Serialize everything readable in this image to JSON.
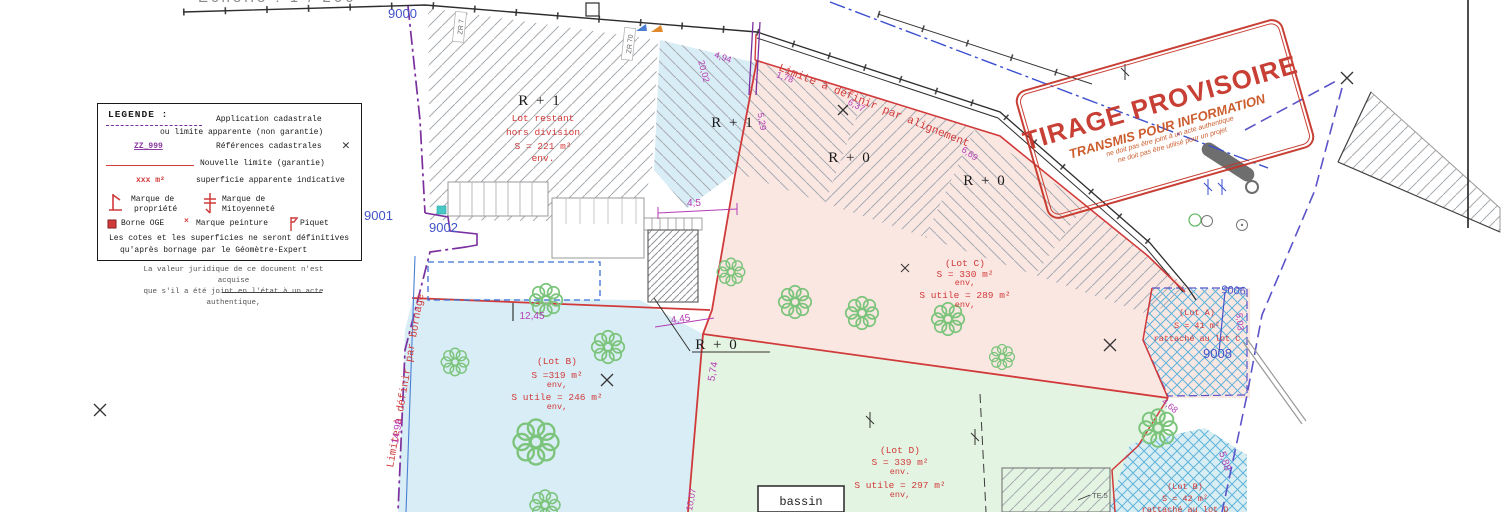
{
  "meta": {
    "scale_note": "Echelle : 1 / 200"
  },
  "stamp": {
    "line1": "TIRAGE PROVISOIRE",
    "line2": "TRANSMIS POUR INFORMATION",
    "line3": "ne doit pas être joint à un acte authentique",
    "line4": "ne doit pas être utilisé pour un projet"
  },
  "legend": {
    "title": "LEGENDE :",
    "app1": "Application cadastrale",
    "app2": "ou limite apparente (non garantie)",
    "ref_code": "ZZ_999",
    "ref_label": "Références cadastrales",
    "new_limit": "Nouvelle limite (garantie)",
    "area_code": "xxx m²",
    "area_label": "superficie apparente indicative",
    "mark1a": "Marque de",
    "mark1b": "propriété",
    "mark2a": "Marque de",
    "mark2b": "Mitoyenneté",
    "borne": "Borne OGE",
    "peinture": "Marque peinture",
    "piquet": "Piquet",
    "note1": "Les cotes et les superficies ne seront définitives",
    "note2": "qu'après bornage par le Géomètre-Expert"
  },
  "footer_note": {
    "line1": "La valeur juridique de ce document n'est acquise",
    "line2": "que s'il a été joint en l'état à un acte authentique,"
  },
  "points": {
    "p9000": "9000",
    "p9001": "9001",
    "p9002": "9002",
    "p9005": "9005",
    "p9008": "9008"
  },
  "floors": {
    "r1_main": "R + 1",
    "r1_b": "R + 1",
    "r0_a": "R + 0",
    "r0_b": "R + 0",
    "r0_c": "R + 0"
  },
  "lot_restant": {
    "l1": "Lot restant",
    "l2": "hors division",
    "l3": "S = 221 m²",
    "l4": "env."
  },
  "lot_c": {
    "name": "(Lot C)",
    "s": "S = 330 m²",
    "env": "env,",
    "su": "S utile = 289 m²",
    "env2": "env,"
  },
  "lot_b": {
    "name": "(Lot B)",
    "s": "S =319 m²",
    "env": "env,",
    "su": "S utile = 246 m²",
    "env2": "env,"
  },
  "lot_d": {
    "name": "(Lot D)",
    "s": "S = 339 m²",
    "env": "env.",
    "su": "S utile = 297 m²",
    "env2": "env,"
  },
  "lot_a": {
    "name": "(Lot A)",
    "s": "S = 41 m²",
    "note": "rattaché au lot C"
  },
  "lot_b2": {
    "name": "(Lot B)",
    "s": "S = 42 m²",
    "note": "rattaché au lot D"
  },
  "boundaries": {
    "alignement": "Limite à définir par alignement",
    "bornage": "Limite à définir par bornage"
  },
  "features": {
    "bassin": "bassin",
    "te5": "TE.5"
  },
  "dims": {
    "d45": "4,5",
    "d445": "4,45",
    "d1245": "12,45",
    "d574": "5,74",
    "d1498": "14,98",
    "d494": "4,94",
    "d2002": "20,02",
    "d178": "1,78",
    "d637": "6,37",
    "d529": "5,29",
    "d669": "6,69",
    "d588": "5,88",
    "d468": "4,68",
    "d503": "5,03",
    "d1007": "10,07"
  },
  "cadastral_refs": {
    "zr1": "ZR 7",
    "zr2": "ZR 70"
  },
  "colors": {
    "stamp_red": "#c43226",
    "new_limit_red": "#d03a3a",
    "boundary_purple": "#7a2f9e",
    "dim_magenta": "#b53db5",
    "point_blue": "#4353c8",
    "lot_b_fill": "#d9edf6",
    "lot_c_fill": "#fbe7e2",
    "lot_d_fill": "#e4f4e2",
    "crosshatch_blue": "#5fb3dc",
    "tree_green": "#7cc47c"
  }
}
